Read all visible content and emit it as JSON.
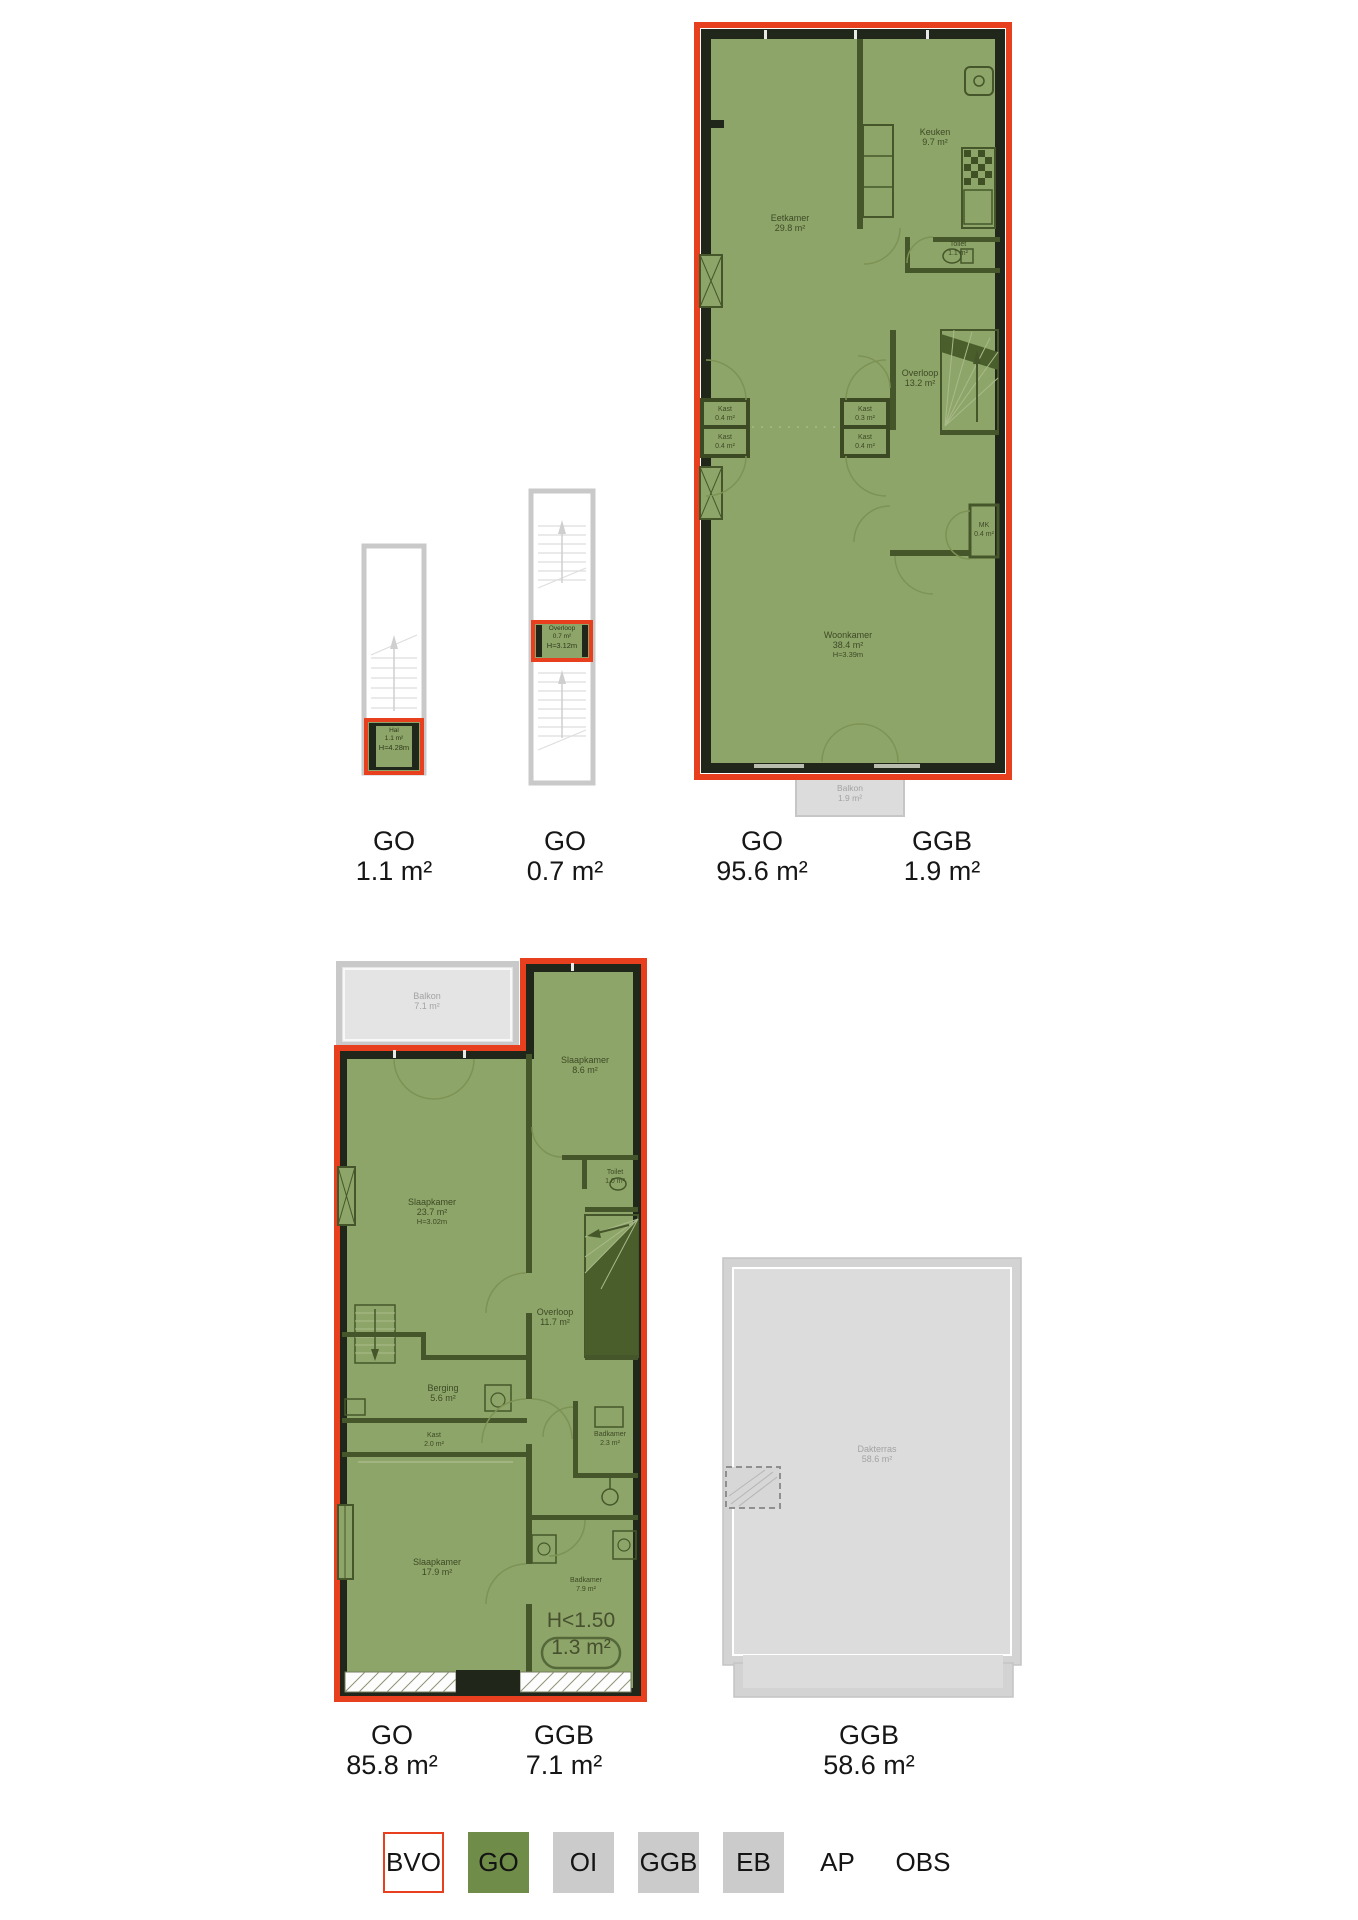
{
  "colors": {
    "accent_red": "#e8401f",
    "go_green": "#6f8c48",
    "ggb_gray": "#cbcbcb"
  },
  "plan_hal": {
    "room": {
      "name": "Hal",
      "area": "1.1 m²",
      "height": "H≈4.28m"
    }
  },
  "plan_overloop": {
    "room": {
      "name": "Overloop",
      "area": "0.7 m²",
      "height": "H≈3.12m"
    }
  },
  "plan_floor1": {
    "rooms": {
      "eetkamer": {
        "name": "Eetkamer",
        "area": "29.8 m²"
      },
      "keuken": {
        "name": "Keuken",
        "area": "9.7 m²"
      },
      "toilet": {
        "name": "Toilet",
        "area": "1.1 m²"
      },
      "overloop": {
        "name": "Overloop",
        "area": "13.2 m²"
      },
      "kast_l1": {
        "name": "Kast",
        "area": "0.4 m²"
      },
      "kast_l2": {
        "name": "Kast",
        "area": "0.4 m²"
      },
      "kast_r1": {
        "name": "Kast",
        "area": "0.3 m²"
      },
      "kast_r2": {
        "name": "Kast",
        "area": "0.4 m²"
      },
      "mk": {
        "name": "MK",
        "area": "0.4 m²"
      },
      "woonkamer": {
        "name": "Woonkamer",
        "area": "38.4 m²",
        "height": "H≈3.39m"
      },
      "balkon": {
        "name": "Balkon",
        "area": "1.9 m²"
      }
    }
  },
  "plan_floor2": {
    "rooms": {
      "balkon": {
        "name": "Balkon",
        "area": "7.1 m²"
      },
      "slaapkamer1": {
        "name": "Slaapkamer",
        "area": "8.6 m²"
      },
      "toilet": {
        "name": "Toilet",
        "area": "1.0 m²"
      },
      "slaapkamer2": {
        "name": "Slaapkamer",
        "area": "23.7 m²",
        "height": "H≈3.02m"
      },
      "overloop": {
        "name": "Overloop",
        "area": "11.7 m²"
      },
      "berging": {
        "name": "Berging",
        "area": "5.6 m²"
      },
      "kast": {
        "name": "Kast",
        "area": "2.0 m²"
      },
      "badkamer1": {
        "name": "Badkamer",
        "area": "2.3 m²"
      },
      "slaapkamer3": {
        "name": "Slaapkamer",
        "area": "17.9 m²"
      },
      "badkamer2": {
        "name": "Badkamer",
        "area": "7.9 m²"
      }
    },
    "annotation": {
      "line1": "H<1.50",
      "line2": "1.3 m²"
    }
  },
  "plan_roof": {
    "room": {
      "name": "Dakterras",
      "area": "58.6 m²"
    }
  },
  "area_labels": {
    "row1": [
      {
        "code": "GO",
        "value": "1.1 m²"
      },
      {
        "code": "GO",
        "value": "0.7 m²"
      },
      {
        "code": "GO",
        "value": "95.6 m²"
      },
      {
        "code": "GGB",
        "value": "1.9 m²"
      }
    ],
    "row2": [
      {
        "code": "GO",
        "value": "85.8 m²"
      },
      {
        "code": "GGB",
        "value": "7.1 m²"
      },
      {
        "code": "GGB",
        "value": "58.6 m²"
      }
    ]
  },
  "legend": {
    "items": [
      {
        "label": "BVO"
      },
      {
        "label": "GO"
      },
      {
        "label": "OI"
      },
      {
        "label": "GGB"
      },
      {
        "label": "EB"
      },
      {
        "label": "AP"
      },
      {
        "label": "OBS"
      }
    ]
  }
}
